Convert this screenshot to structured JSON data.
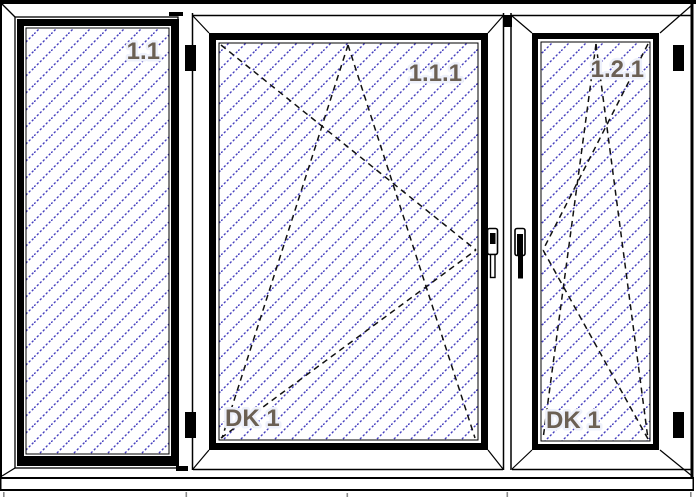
{
  "drawing": {
    "title": "window-elevation-drawing",
    "panes": [
      {
        "id": "1.1",
        "opening_label": "",
        "position": "left",
        "type": "fixed-glazing"
      },
      {
        "id": "1.1.1",
        "opening_label": "DK 1",
        "position": "center",
        "type": "tilt-turn"
      },
      {
        "id": "1.2.1",
        "opening_label": "DK 1",
        "position": "right",
        "type": "tilt-turn"
      }
    ],
    "colors": {
      "hatch_blue": "#4640bf",
      "label_brown": "#6b6054",
      "frame_black": "#000000",
      "tick_gray": "#8a8a8a"
    }
  }
}
